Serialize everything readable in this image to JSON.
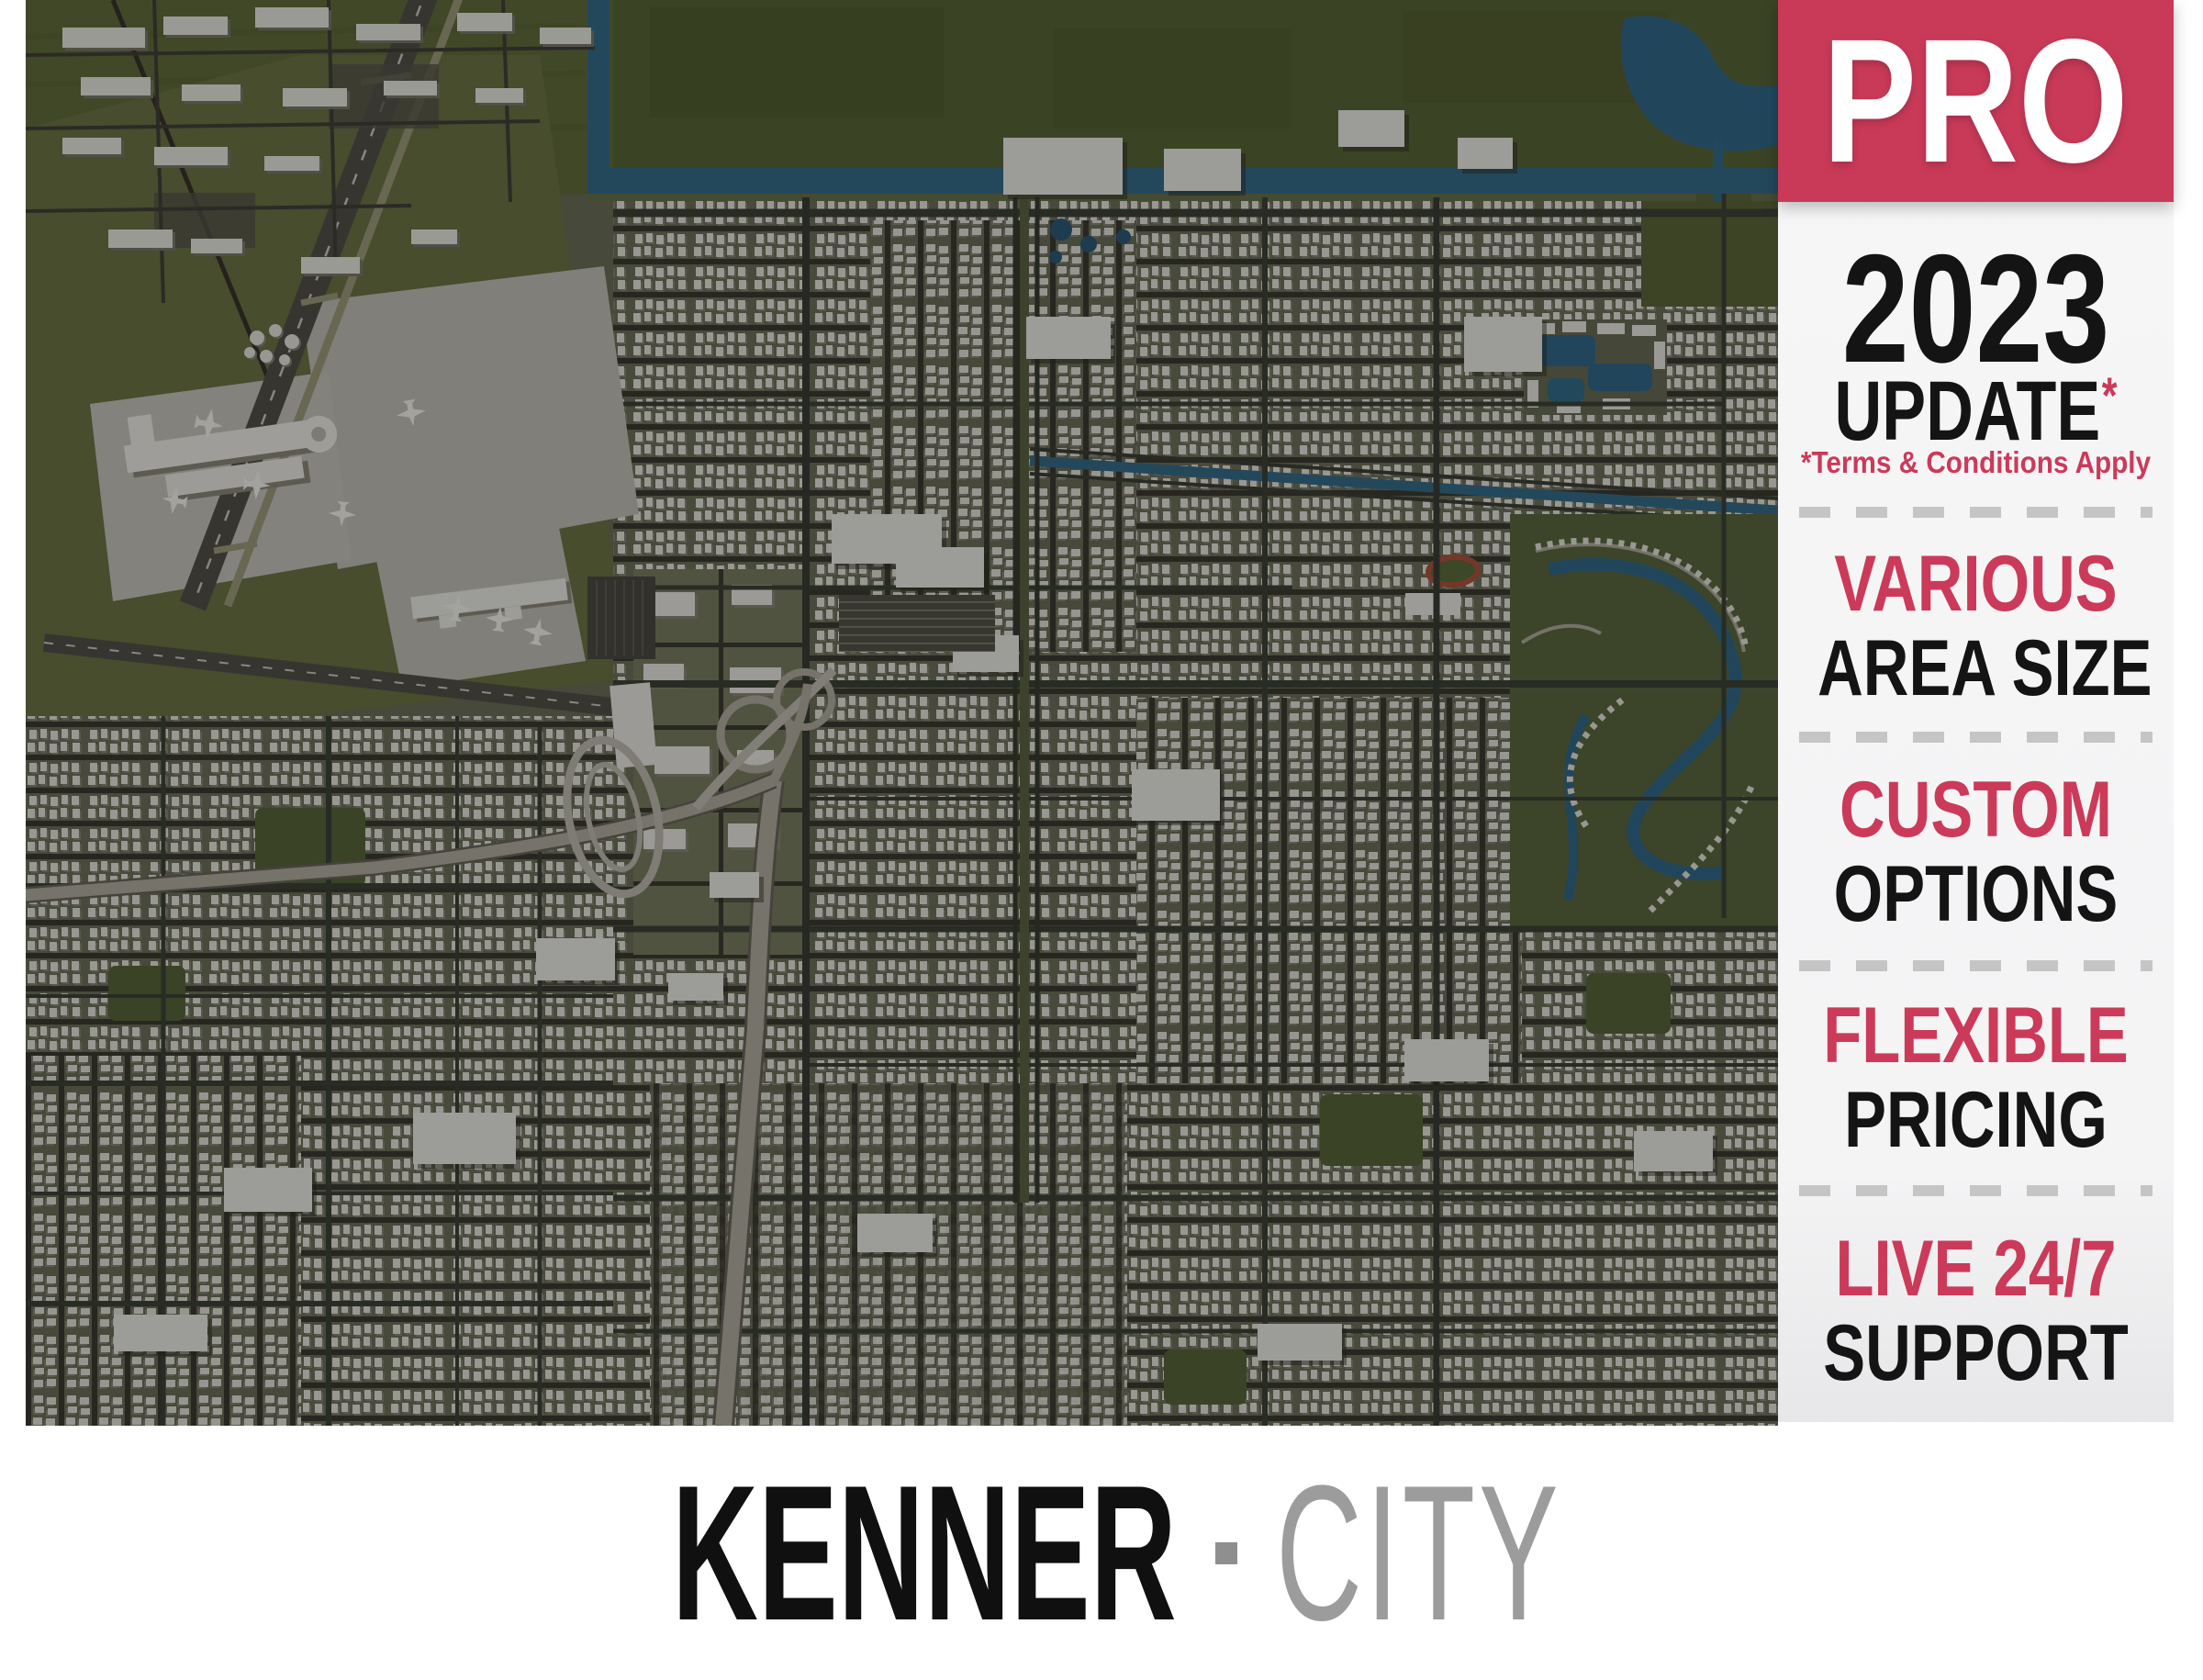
{
  "product": {
    "badge": "PRO",
    "year": "2023",
    "update_word": "UPDATE",
    "update_asterisk": "*",
    "terms_note": "*Terms & Conditions Apply",
    "features": [
      {
        "accent": "VARIOUS",
        "rest": "AREA SIZE"
      },
      {
        "accent": "CUSTOM",
        "rest": "OPTIONS"
      },
      {
        "accent": "FLEXIBLE",
        "rest": "PRICING"
      },
      {
        "accent": "LIVE 24/7",
        "rest": "SUPPORT"
      }
    ]
  },
  "title": {
    "primary": "KENNER",
    "separator": "·",
    "secondary": "CITY"
  },
  "colors": {
    "accent_red": "#cc3a59",
    "badge_bg": "#c93a58",
    "badge_text": "#ffffff",
    "heading_black": "#141414",
    "secondary_gray": "#9c9c9c",
    "divider_gray": "#c5c5c5",
    "panel_bg": "#f5f5f6"
  },
  "map": {
    "subject": "aerial-3d-render-kenner-city",
    "landmarks": [
      "international-airport-runways-and-terminal",
      "residential-street-grid",
      "highway-interchange",
      "drainage-canals-and-lake",
      "lagoon-suburb",
      "green-fields"
    ],
    "palette": {
      "ground": "#70735c",
      "field_green": "#65703e",
      "water_blue": "#36708e",
      "road_dark": "#3e3c32",
      "concrete": "#c9c6be",
      "building_white": "#eceae2"
    }
  }
}
